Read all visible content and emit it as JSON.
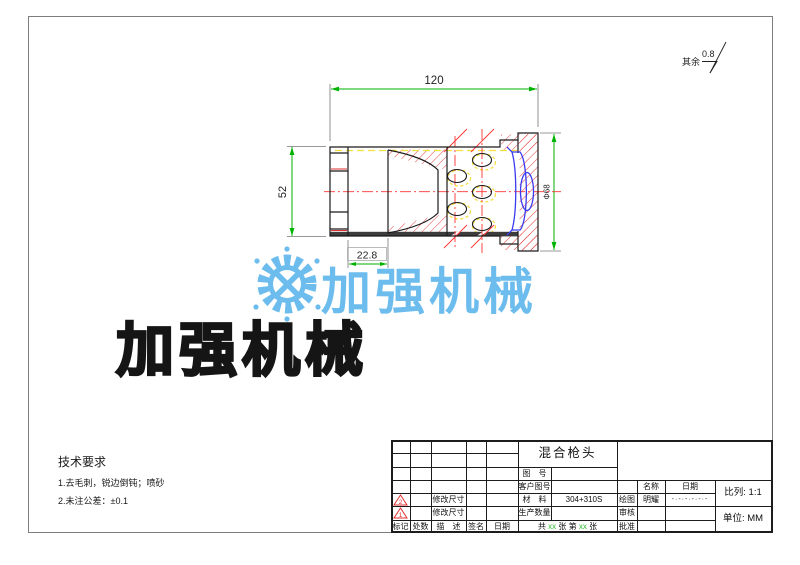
{
  "surface_note": {
    "label": "其余",
    "value": "0.8"
  },
  "dimensions": {
    "length": "120",
    "height": "52",
    "inlet_depth": "22.8",
    "flange_dia": "Φ68"
  },
  "watermark": {
    "brand_blue": "加强机械",
    "brand_black": "加强机械"
  },
  "tech_req": {
    "title": "技术要求",
    "line1": "1.去毛刺，锐边倒钝；喷砂",
    "line2": "2.未注公差：±0.1"
  },
  "title_block": {
    "part_name": "混合枪头",
    "drawing_no_label": "图　号",
    "customer_no_label": "客户图号",
    "material_label": "材　料",
    "material_value": "304+310S",
    "quantity_label": "生产数量",
    "rev1_mark": "2",
    "rev1_desc": "修改尺寸",
    "rev2_mark": "1",
    "rev2_desc": "修改尺寸",
    "header_mark": "标记",
    "header_count": "处数",
    "header_desc": "描　述",
    "header_sign": "签名",
    "header_date": "日期",
    "name_header": "名称",
    "date_header": "日期",
    "draw_label": "绘图",
    "draw_name": "明耀",
    "draw_date": "-·-·-·-·-·-",
    "check_label": "审核",
    "approve_label": "批准",
    "scale_label": "比列:",
    "scale_value": "1:1",
    "unit_label": "单位:",
    "unit_value": "MM",
    "sheet_prefix": "共",
    "sheet_count": "xx",
    "sheet_mid": "张 第",
    "sheet_num": "xx",
    "sheet_suffix": "张"
  },
  "colors": {
    "brand_blue": "#6cbdee",
    "dimension_green": "#00b300",
    "centerline_red": "#ff3333",
    "hatch_red": "#e23b3b",
    "section_blue": "#3a3af0",
    "highlight_yellow": "#f4df3c"
  }
}
